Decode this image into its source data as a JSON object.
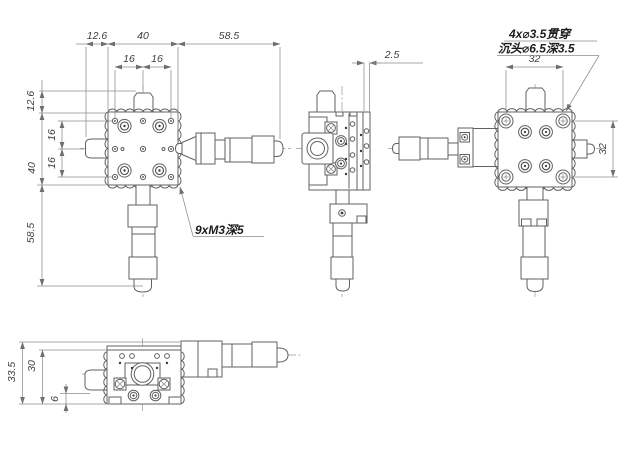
{
  "dims": {
    "front_top_offset": "12.6",
    "front_top_width": "40",
    "front_top_mic": "58.5",
    "front_top_pitch_a": "16",
    "front_top_pitch_b": "16",
    "front_left_offset": "12.6",
    "front_left_height": "40",
    "front_left_mic": "58.5",
    "front_left_pitch_a": "16",
    "front_left_pitch_b": "16",
    "side_gap": "2.5",
    "cb_span_top": "32",
    "cb_span_side": "32",
    "bottom_total": "33.5",
    "bottom_body": "30",
    "bottom_base": "6"
  },
  "notes": {
    "tapped_holes": "9xM3深5",
    "counterbore_line1": "4x⌀3.5贯穿",
    "counterbore_line2": "沉头⌀6.5深3.5"
  }
}
